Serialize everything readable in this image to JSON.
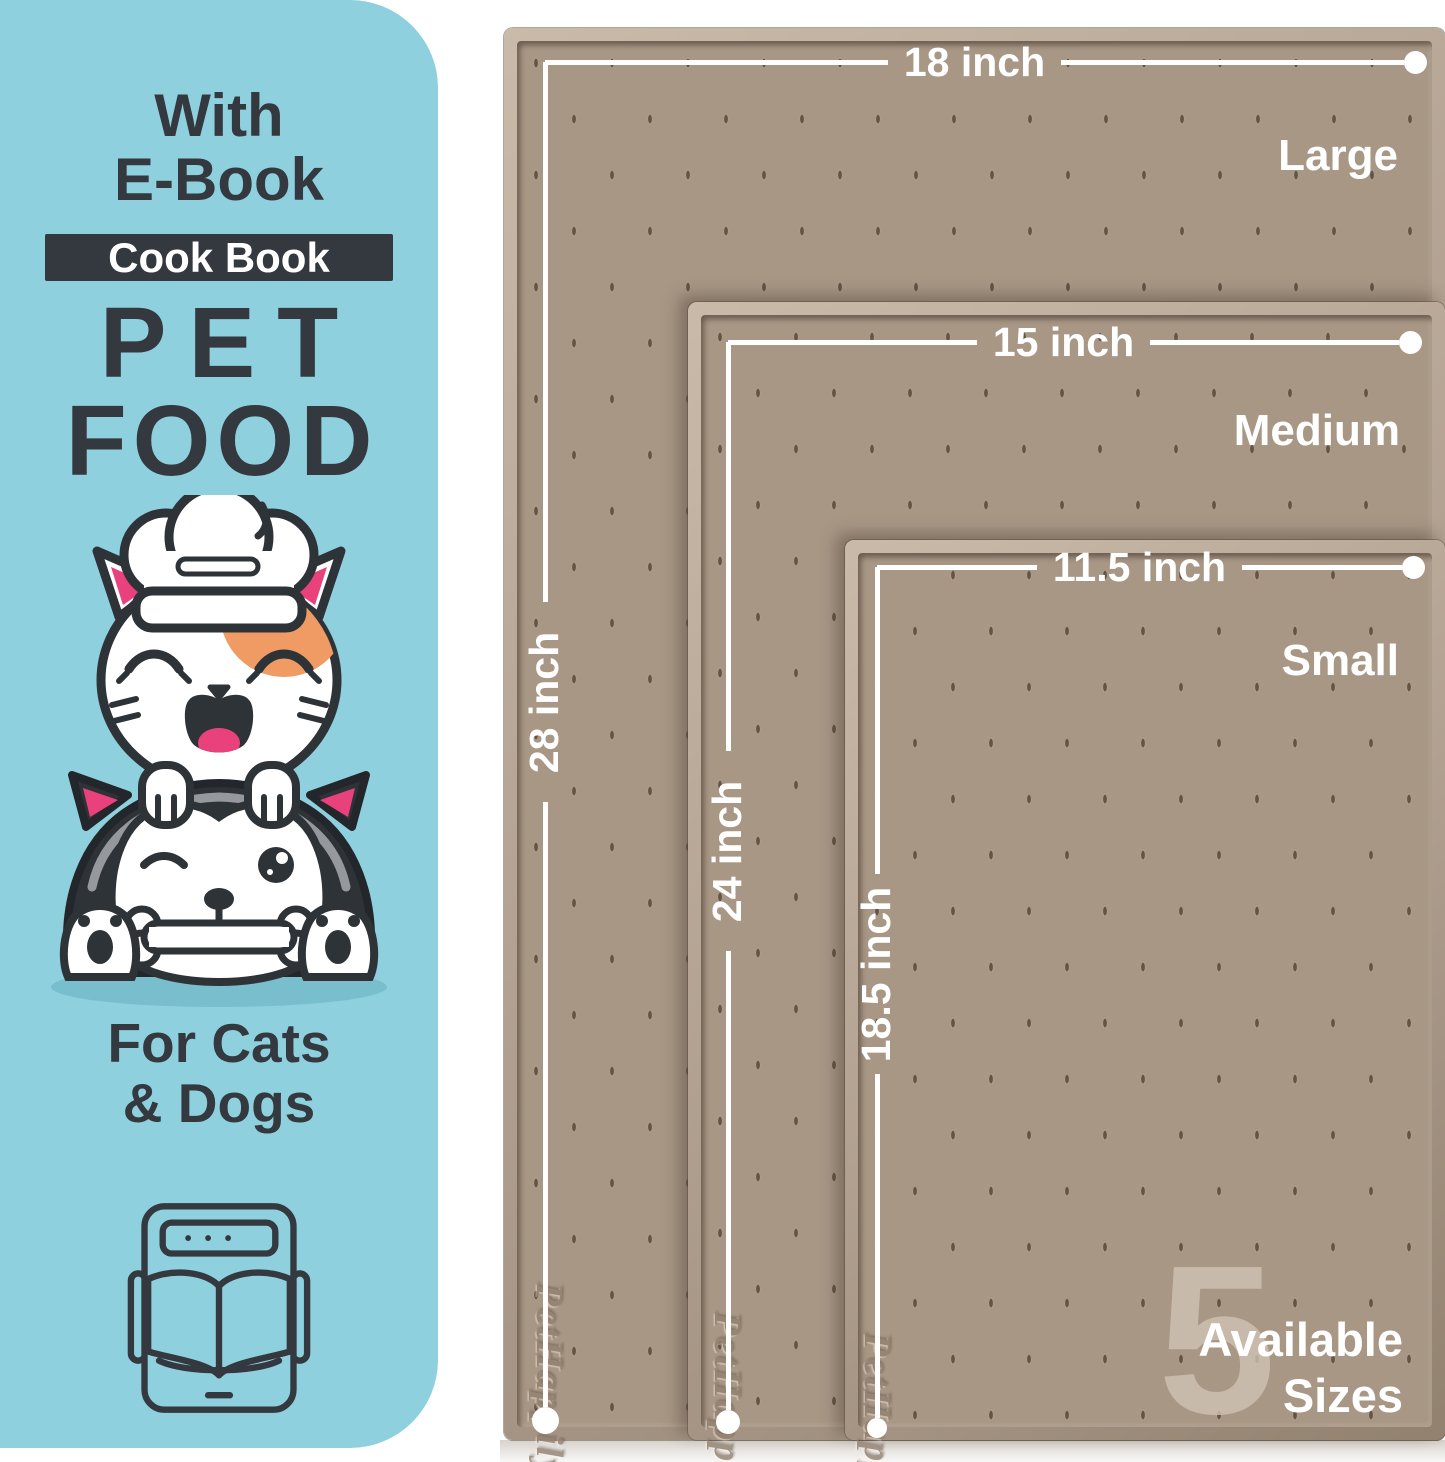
{
  "colors": {
    "sidebar_bg": "#8ed0dd",
    "ink": "#34383f",
    "accent_pink": "#e8417c",
    "accent_orange": "#f09a64",
    "mat_surface": "#a99786",
    "mat_rim": "#b3a292",
    "dimension_line": "#ffffff"
  },
  "sidebar": {
    "headline_line1": "With",
    "headline_line2": "E-Book",
    "badge_label": "Cook Book",
    "title_line1": "PET",
    "title_line2": "FOOD",
    "audience_line1": "For Cats",
    "audience_line2": "& Dogs"
  },
  "mats": {
    "brand_embossed": "PetHappily",
    "items": [
      {
        "size_label": "Large",
        "width_label": "18 inch",
        "height_label": "28 inch"
      },
      {
        "size_label": "Medium",
        "width_label": "15 inch",
        "height_label": "24 inch"
      },
      {
        "size_label": "Small",
        "width_label": "11.5 inch",
        "height_label": "18.5 inch"
      }
    ]
  },
  "availability": {
    "count": "5",
    "line1": "Available",
    "line2": "Sizes"
  }
}
